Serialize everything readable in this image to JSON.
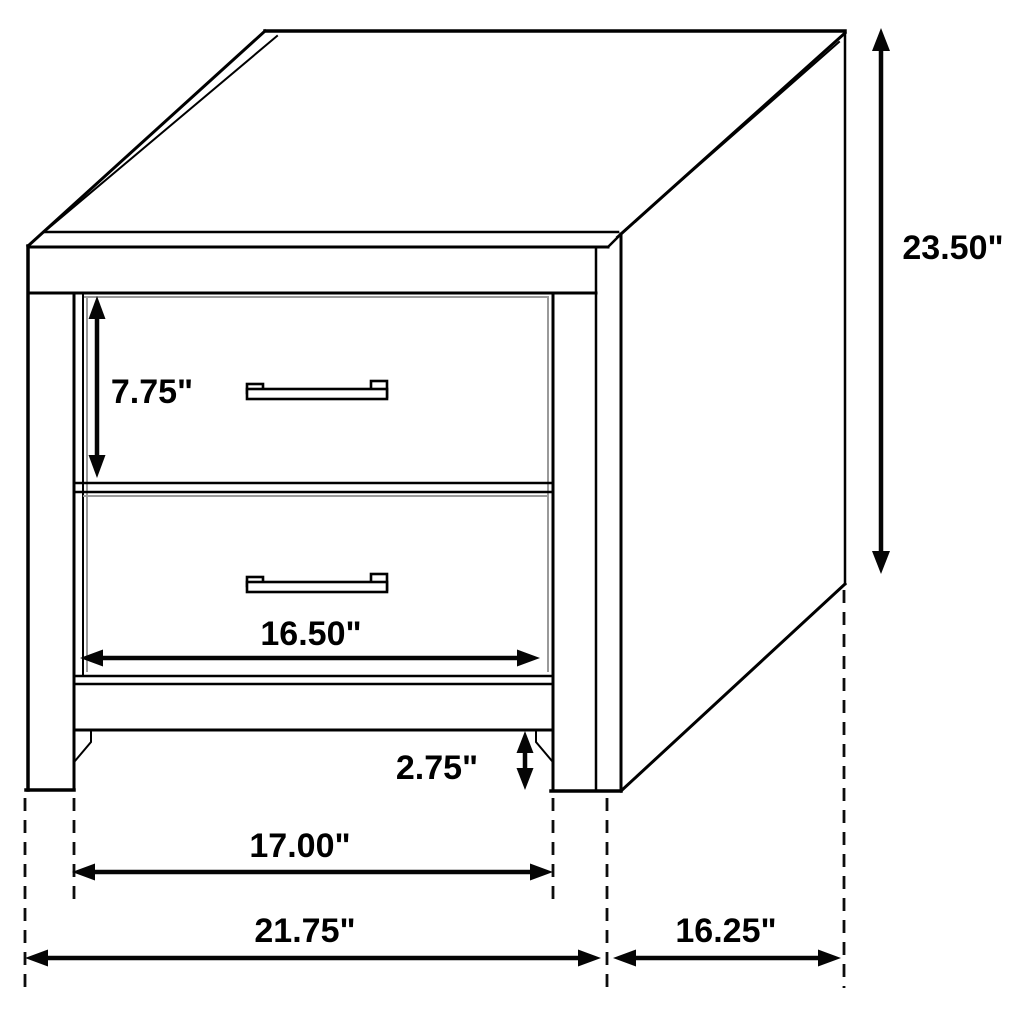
{
  "diagram": {
    "subject": "2-drawer nightstand dimension drawing",
    "background_color": "#ffffff",
    "line_color": "#000000",
    "labels": {
      "overall_height": "23.50\"",
      "top_drawer_height": "7.75\"",
      "drawer_front_width": "16.50\"",
      "base_clearance_height": "2.75\"",
      "inner_leg_span": "17.00\"",
      "overall_front_width": "21.75\"",
      "side_depth": "16.25\""
    }
  }
}
